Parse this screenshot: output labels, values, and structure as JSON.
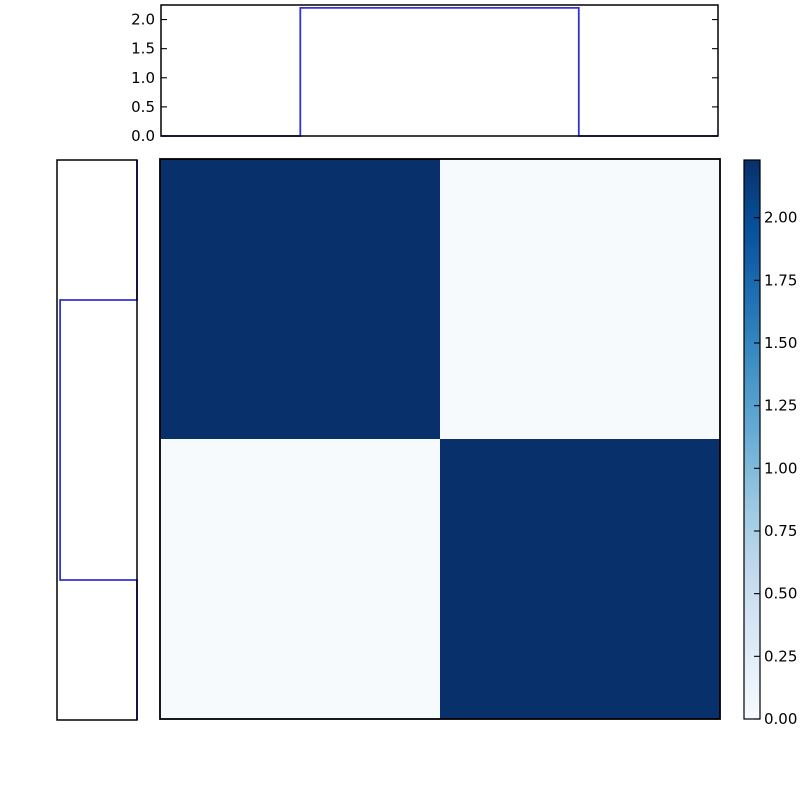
{
  "figure": {
    "background": "#ffffff",
    "width": 800,
    "height": 800,
    "title": ""
  },
  "style": {
    "spine_color": "#000000",
    "tick_color": "#000000",
    "label_color": "#000000",
    "tick_font_size": 15,
    "tick_length": 6
  },
  "chart_data": [
    {
      "id": "top_marginal",
      "type": "line",
      "role": "top marginal step plot (horizontal axis shared with heatmap columns)",
      "line_color": "#3333d6",
      "x": [
        0,
        0.5,
        0.5,
        1.5,
        1.5,
        2
      ],
      "y": [
        0,
        0,
        2.2,
        2.2,
        0,
        0
      ],
      "xlim": [
        0,
        2
      ],
      "ylim": [
        0,
        2.25
      ],
      "yticks": [
        0.0,
        0.5,
        1.0,
        1.5,
        2.0
      ],
      "ytick_labels": [
        "0.0",
        "0.5",
        "1.0",
        "1.5",
        "2.0"
      ],
      "xtick_labels": [],
      "grid": false,
      "legend": null
    },
    {
      "id": "left_marginal",
      "type": "line",
      "role": "left marginal step plot (vertical axis shared with heatmap rows, value increases leftward)",
      "line_color": "#3333d6",
      "y": [
        0,
        0.5,
        0.5,
        1.5,
        1.5,
        2
      ],
      "v": [
        0,
        0,
        2.2,
        2.2,
        0,
        0
      ],
      "ylim": [
        0,
        2
      ],
      "vlim": [
        0,
        2.29
      ],
      "tick_labels": [],
      "grid": false,
      "legend": null
    },
    {
      "id": "joint_heatmap",
      "type": "heatmap",
      "rows": 2,
      "cols": 2,
      "matrix": [
        [
          2.23,
          0.02
        ],
        [
          0.02,
          2.23
        ]
      ],
      "vmin": 0,
      "vmax": 2.23,
      "colormap": "Blues",
      "cell_colors": [
        [
          "#08306b",
          "#f7fafd"
        ],
        [
          "#f7fafd",
          "#08306b"
        ]
      ],
      "xtick_labels": [],
      "ytick_labels": [],
      "grid": false
    },
    {
      "id": "colorbar",
      "type": "colorbar",
      "orientation": "vertical",
      "vmin": 0.0,
      "vmax": 2.23,
      "tick_values": [
        0.0,
        0.25,
        0.5,
        0.75,
        1.0,
        1.25,
        1.5,
        1.75,
        2.0
      ],
      "tick_labels": [
        "0.00",
        "0.25",
        "0.50",
        "0.75",
        "1.00",
        "1.25",
        "1.50",
        "1.75",
        "2.00"
      ],
      "gradient_stops": [
        {
          "frac": 0.0,
          "color": "#f7fbff"
        },
        {
          "frac": 0.125,
          "color": "#deebf7"
        },
        {
          "frac": 0.25,
          "color": "#c6dbef"
        },
        {
          "frac": 0.375,
          "color": "#9ecae1"
        },
        {
          "frac": 0.5,
          "color": "#6baed6"
        },
        {
          "frac": 0.625,
          "color": "#4292c6"
        },
        {
          "frac": 0.75,
          "color": "#2171b5"
        },
        {
          "frac": 0.875,
          "color": "#08519c"
        },
        {
          "frac": 1.0,
          "color": "#08306b"
        }
      ]
    }
  ]
}
